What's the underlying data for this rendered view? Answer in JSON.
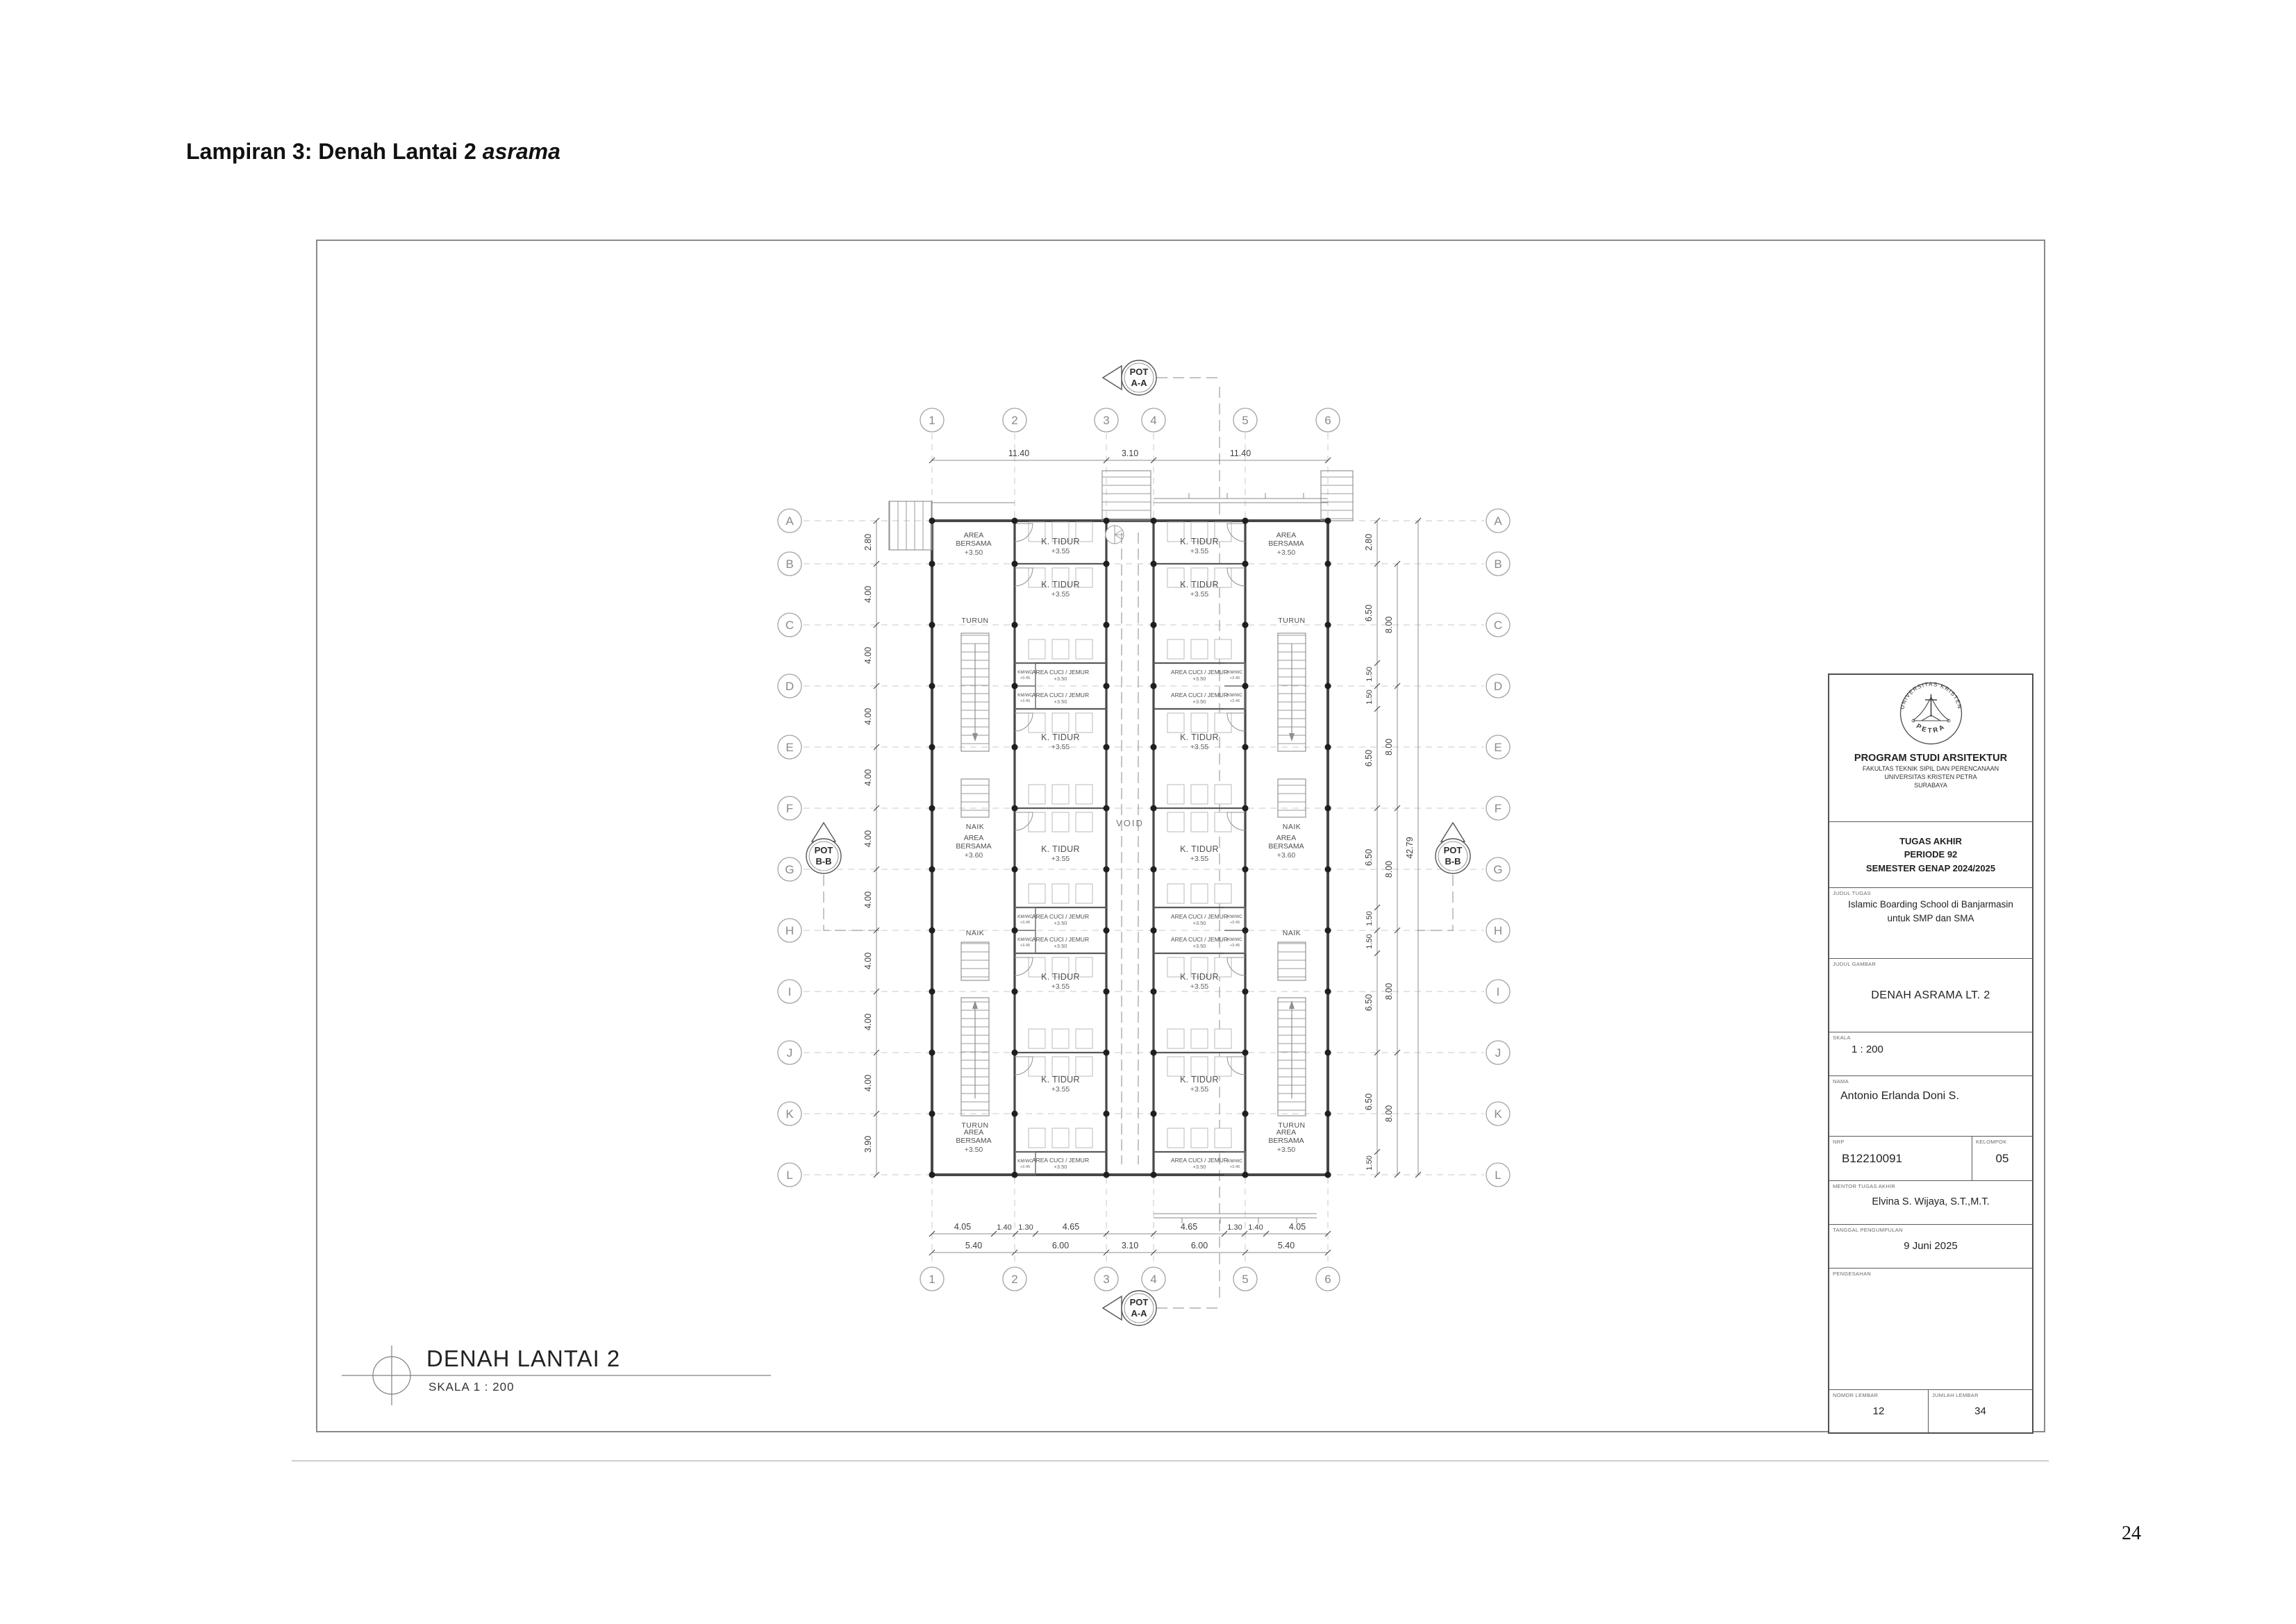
{
  "page": {
    "heading_prefix": "Lampiran 3: Denah Lantai 2 ",
    "heading_italic": "asrama",
    "page_number": "24"
  },
  "drawing_title": {
    "text": "DENAH LANTAI 2",
    "scale": "SKALA 1 : 200"
  },
  "plan": {
    "grid": {
      "cols": [
        "1",
        "2",
        "3",
        "4",
        "5",
        "6"
      ],
      "rows": [
        "A",
        "B",
        "C",
        "D",
        "E",
        "F",
        "G",
        "H",
        "I",
        "J",
        "K",
        "L"
      ]
    },
    "dims": {
      "top": [
        "11.40",
        "3.10",
        "11.40"
      ],
      "bottom_detail": [
        "4.05",
        "1.40",
        "1.30",
        "4.65",
        "4.65",
        "1.30",
        "1.40",
        "4.05"
      ],
      "bottom_main": [
        "5.40",
        "6.00",
        "3.10",
        "6.00",
        "5.40"
      ],
      "left": [
        "2.80",
        "4.00",
        "4.00",
        "4.00",
        "4.00",
        "4.00",
        "4.00",
        "4.00",
        "4.00",
        "4.00",
        "3.90"
      ],
      "right_inner": [
        "2.80",
        "6.50",
        "1.50",
        "1.50",
        "6.50",
        "6.50",
        "1.50",
        "1.50",
        "6.50",
        "6.50",
        "1.50"
      ],
      "right_mid": [
        "8.00",
        "8.00",
        "8.00",
        "8.00",
        "8.00"
      ],
      "right_total": "42.79"
    },
    "labels": {
      "k_tidur": "K. TIDUR",
      "lvl355": "+3.55",
      "area": "AREA",
      "bersama": "BERSAMA",
      "lvl350": "+3.50",
      "lvl360": "+3.60",
      "cuci": "AREA CUCI / JEMUR",
      "kmwc": "KM/WC",
      "lvl345": "+3.45",
      "void": "VOID",
      "turun": "TURUN",
      "naik": "NAIK"
    },
    "markers": {
      "pot": "POT",
      "aa": "A-A",
      "bb": "B-B"
    }
  },
  "title_block": {
    "logo_top": "UNIVERSITAS KRISTEN",
    "logo_bottom": "PETRA",
    "program": "PROGRAM STUDI ARSITEKTUR",
    "fakultas": "FAKULTAS TEKNIK SIPIL DAN PERENCANAAN",
    "universitas": "UNIVERSITAS KRISTEN PETRA",
    "kota": "SURABAYA",
    "tugas": "TUGAS AKHIR",
    "periode": "PERIODE 92",
    "semester": "SEMESTER GENAP 2024/2025",
    "judul_tugas_label": "JUDUL TUGAS",
    "judul_tugas": "Islamic Boarding School di Banjarmasin untuk SMP dan SMA",
    "judul_gambar_label": "JUDUL GAMBAR",
    "judul_gambar": "DENAH ASRAMA LT. 2",
    "skala_label": "SKALA",
    "skala": "1 : 200",
    "nama_label": "NAMA",
    "nama": "Antonio Erlanda Doni S.",
    "nrp_label": "NRP",
    "nrp": "B12210091",
    "kelompok_label": "KELOMPOK",
    "kelompok": "05",
    "mentor_label": "MENTOR TUGAS AKHIR",
    "mentor": "Elvina S. Wijaya, S.T.,M.T.",
    "tanggal_label": "TANGGAL PENGUMPULAN",
    "tanggal": "9 Juni 2025",
    "pengesahan_label": "PENGESAHAN",
    "nomor_label": "NOMOR LEMBAR",
    "nomor": "12",
    "jumlah_label": "JUMLAH LEMBAR",
    "jumlah": "34"
  }
}
